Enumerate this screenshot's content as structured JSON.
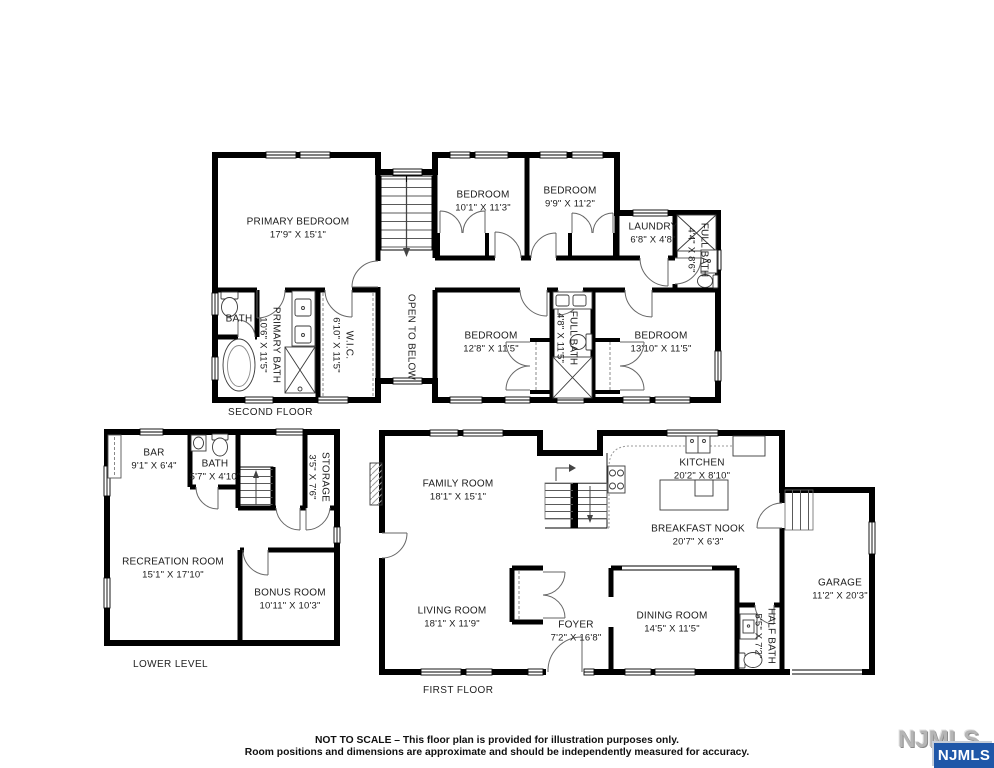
{
  "floors": [
    {
      "label": "SECOND FLOOR",
      "rooms": [
        {
          "name": "PRIMARY BEDROOM",
          "dims": "17'9\" X 15'1\""
        },
        {
          "name": "BEDROOM",
          "dims": "10'1\" X 11'3\""
        },
        {
          "name": "BEDROOM",
          "dims": "9'9\" X 11'2\""
        },
        {
          "name": "LAUNDRY",
          "dims": "6'8\" X 4'8\""
        },
        {
          "name": "FULL BATH",
          "dims": "4'4\" X 8'6\""
        },
        {
          "name": "BATH",
          "dims": ""
        },
        {
          "name": "PRIMARY BATH",
          "dims": "10'6\" X 11'5\""
        },
        {
          "name": "W.I.C.",
          "dims": "6'10\" X 11'5\""
        },
        {
          "name": "OPEN TO BELOW",
          "dims": ""
        },
        {
          "name": "BEDROOM",
          "dims": "12'8\" X 11'5\""
        },
        {
          "name": "FULL BATH",
          "dims": "4'8\" X 11'5\""
        },
        {
          "name": "BEDROOM",
          "dims": "13'10\" X 11'5\""
        }
      ]
    },
    {
      "label": "LOWER LEVEL",
      "rooms": [
        {
          "name": "BAR",
          "dims": "9'1\" X 6'4\""
        },
        {
          "name": "BATH",
          "dims": "5'7\" X 4'10\""
        },
        {
          "name": "STORAGE",
          "dims": "3'5\" X 7'6\""
        },
        {
          "name": "RECREATION ROOM",
          "dims": "15'1\" X 17'10\""
        },
        {
          "name": "BONUS ROOM",
          "dims": "10'11\" X 10'3\""
        }
      ]
    },
    {
      "label": "FIRST FLOOR",
      "rooms": [
        {
          "name": "FAMILY ROOM",
          "dims": "18'1\" X 15'1\""
        },
        {
          "name": "KITCHEN",
          "dims": "20'2\" X 8'10\""
        },
        {
          "name": "BREAKFAST NOOK",
          "dims": "20'7\" X 6'3\""
        },
        {
          "name": "LIVING ROOM",
          "dims": "18'1\" X 11'9\""
        },
        {
          "name": "FOYER",
          "dims": "7'2\" X 16'8\""
        },
        {
          "name": "DINING ROOM",
          "dims": "14'5\" X 11'5\""
        },
        {
          "name": "HALF BATH",
          "dims": "5'5\" X 7'2\""
        },
        {
          "name": "GARAGE",
          "dims": "11'2\" X 20'3\""
        }
      ]
    }
  ],
  "disclaimer": {
    "line1": "NOT TO SCALE – This floor plan is provided for illustration purposes only.",
    "line2": "Room positions and dimensions are approximate and should be independently measured for accuracy."
  },
  "logo": {
    "watermark": "NJMLS",
    "badge": "NJMLS",
    "badge_color": "#1f57a8"
  }
}
